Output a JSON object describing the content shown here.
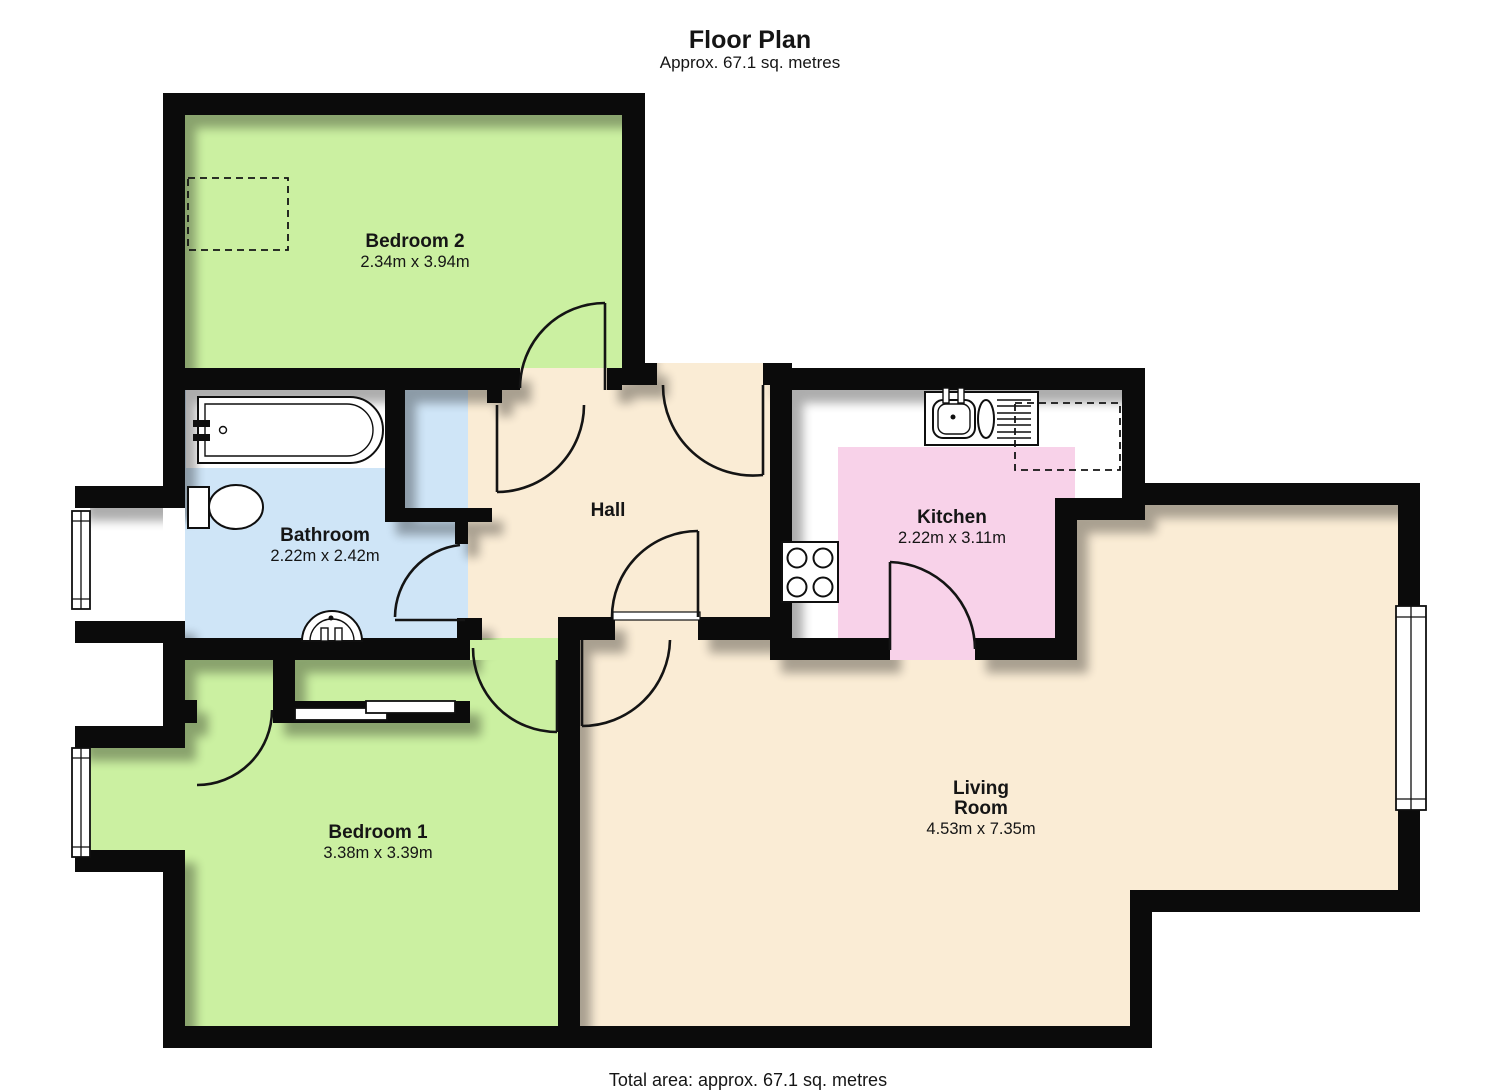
{
  "header": {
    "title": "Floor Plan",
    "subtitle": "Approx.  67.1 sq. metres"
  },
  "footer": {
    "total_area": "Total area: approx.  67.1 sq. metres"
  },
  "rooms": {
    "bedroom2": {
      "name": "Bedroom 2",
      "dimensions": "2.34m x 3.94m",
      "floor_color": "#cbf0a1"
    },
    "bathroom": {
      "name": "Bathroom",
      "dimensions": "2.22m x 2.42m",
      "floor_color": "#cfe5f7"
    },
    "hall": {
      "name": "Hall",
      "floor_color": "#faecd5"
    },
    "kitchen": {
      "name": "Kitchen",
      "dimensions": "2.22m x 3.11m",
      "floor_color": "#f8d2e9"
    },
    "bedroom1": {
      "name": "Bedroom 1",
      "dimensions": "3.38m x 3.39m",
      "floor_color": "#cbf0a1"
    },
    "living_room": {
      "name_line1": "Living",
      "name_line2": "Room",
      "dimensions": "4.53m x 7.35m",
      "floor_color": "#faecd5"
    }
  },
  "colors": {
    "wall": "#0b0b0b",
    "floor_beige": "#faecd5",
    "floor_green": "#cbf0a1",
    "floor_blue": "#cfe5f7",
    "kitchen_pink": "#f8d2e9",
    "background": "#ffffff",
    "text": "#151515"
  },
  "fixtures": [
    "bathtub",
    "toilet",
    "wash-basin",
    "kitchen-sink",
    "draining-board",
    "hob",
    "worktop",
    "wardrobe",
    "window",
    "door-swing"
  ]
}
